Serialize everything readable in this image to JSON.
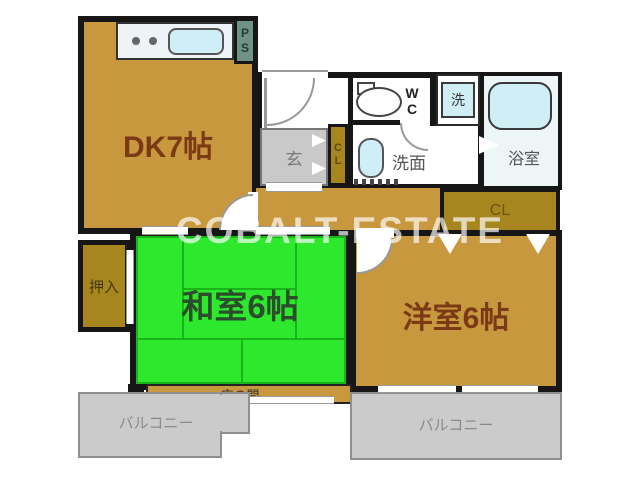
{
  "watermark": "COBALT-ESTATE",
  "rooms": {
    "dk": "DK7帖",
    "entrance": "玄",
    "hall_closet": "CL",
    "washroom": "洗面",
    "toilet": "WC",
    "laundry": "洗",
    "bathroom": "浴室",
    "pipe_space": "PS",
    "bedroom_closet": "CL",
    "oshiire": "押入",
    "japanese_room": "和室6帖",
    "western_room": "洋室6帖",
    "tokonoma": "床の間",
    "balcony_left": "バルコニー",
    "balcony_right": "バルコニー"
  },
  "colors": {
    "room_tan": "#c8983f",
    "closet_gold": "#a8861f",
    "tatami_green": "#2ee82e",
    "pipe_space_teal": "#6e9283",
    "entrance_gray": "#c9c9c9",
    "balcony_gray": "#cbcbcb",
    "fixture_blue": "#cfeef6",
    "wall_black": "#161616",
    "dk_label_brown": "#7b3a15",
    "washitsu_label_green": "#2b4d2b"
  }
}
